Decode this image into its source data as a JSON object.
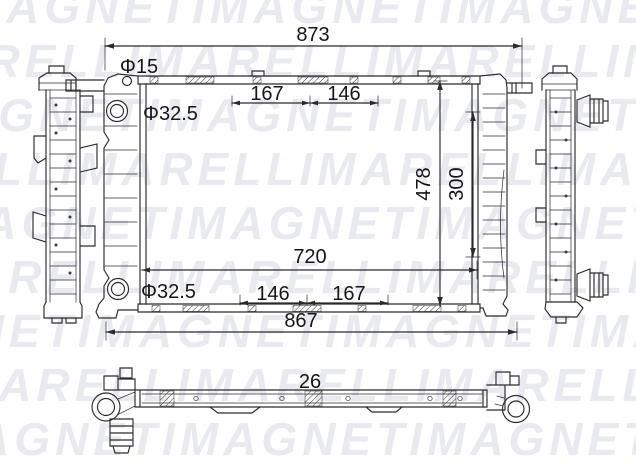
{
  "watermark": {
    "brand": "MAGNETI MARELLI",
    "color": "#e8eaf0",
    "rows": [
      "IMAGNETIMAGNETIMAGNETIM",
      "MARELLIMARELLIMARELLIMA",
      "AGNETIMAGNETIMAGNETIMAG",
      "RELLIMARELLIMARELLIMARE",
      "MAGNETIMAGNETIMAGNETIMA",
      "ARELLIMARELLIMARELLIMAR",
      "GNETIMAGNETIMAGNETIMAGN",
      "MARELLIMARELLIMARELLIMA",
      "IMAGNETIMAGNETIMAGNETIM"
    ]
  },
  "drawing": {
    "line_color": "#2b2b2b",
    "dimensions": {
      "top_width": "873",
      "mount_hole_dia": "Φ15",
      "top_port_dia": "Φ32.5",
      "top_left_span": "167",
      "top_right_span": "146",
      "overall_height": "478",
      "inner_height": "300",
      "core_width": "720",
      "bottom_port_dia": "Φ32.5",
      "bottom_left_span": "146",
      "bottom_right_span": "167",
      "bottom_width": "867",
      "core_depth": "26"
    }
  }
}
